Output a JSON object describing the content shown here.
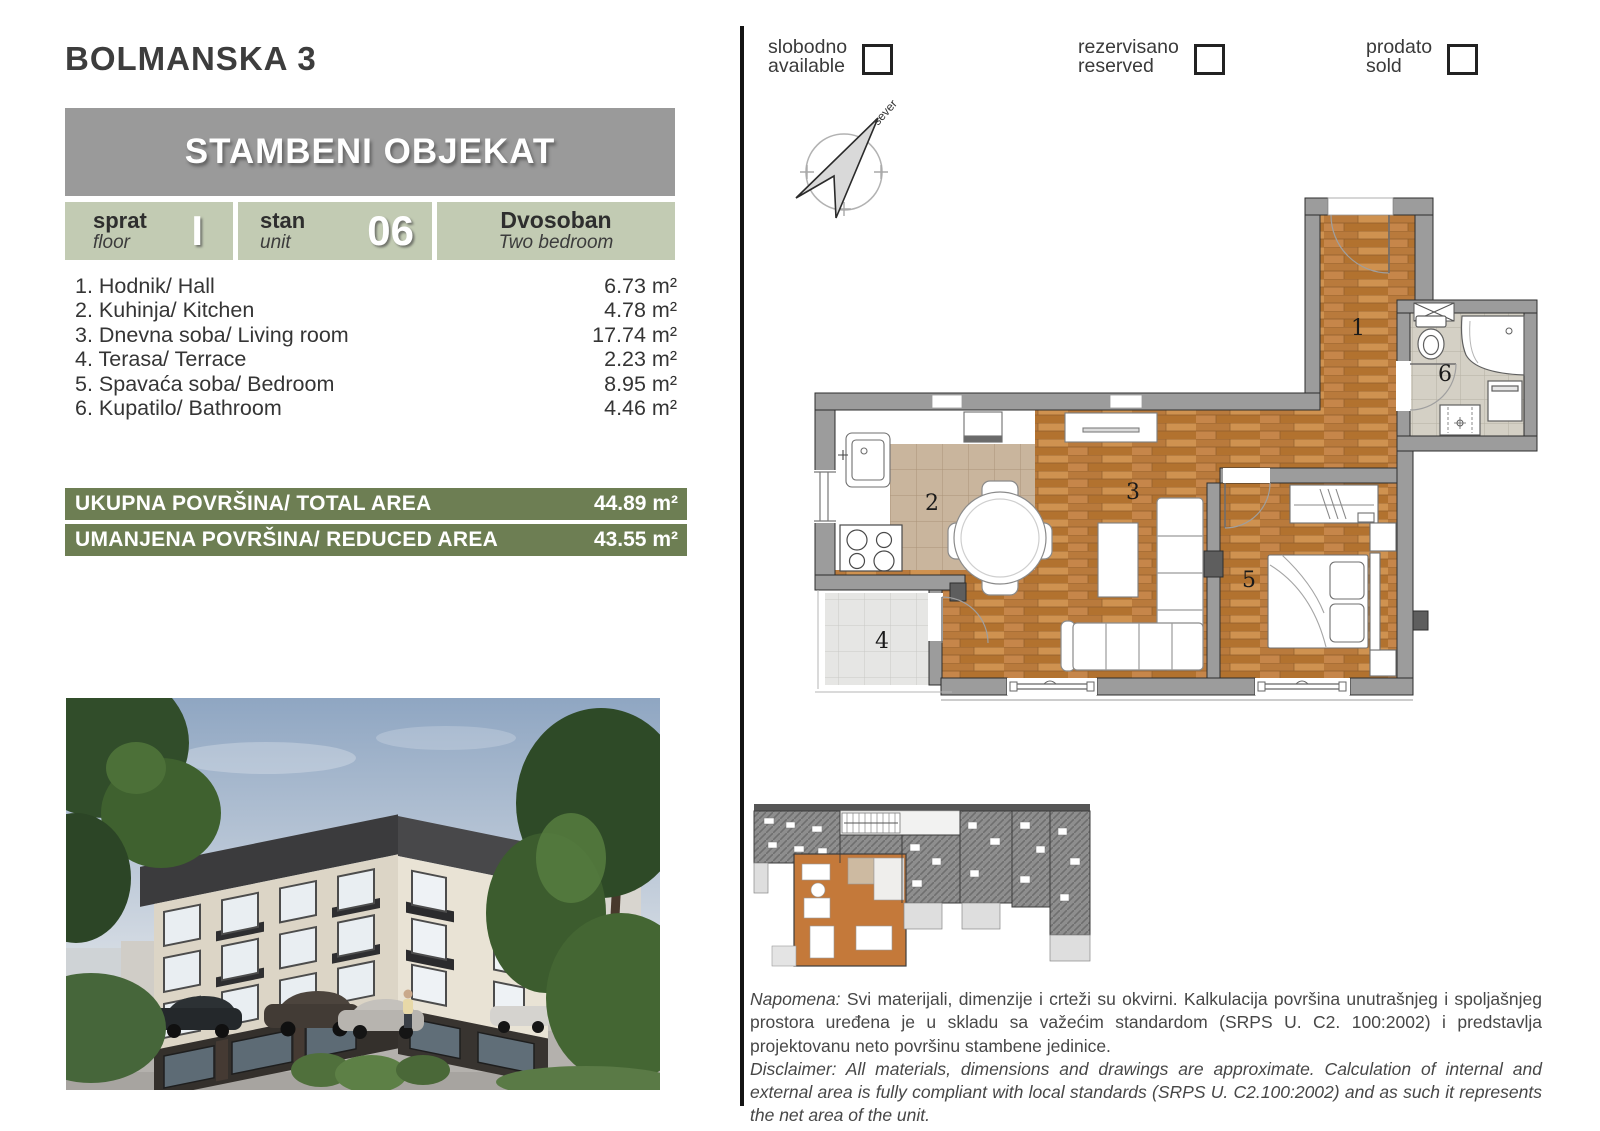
{
  "header": {
    "project_title": "BOLMANSKA 3",
    "banner_title": "STAMBENI OBJEKAT"
  },
  "info": {
    "floor": {
      "label_sr": "sprat",
      "label_en": "floor",
      "value": "I"
    },
    "unit": {
      "label_sr": "stan",
      "label_en": "unit",
      "value": "06"
    },
    "type": {
      "name_sr": "Dvosoban",
      "name_en": "Two bedroom"
    }
  },
  "rooms": [
    {
      "label": "1. Hodnik/ Hall",
      "area": "6.73 m²"
    },
    {
      "label": "2. Kuhinja/ Kitchen",
      "area": "4.78 m²"
    },
    {
      "label": "3. Dnevna soba/ Living room",
      "area": "17.74 m²"
    },
    {
      "label": "4. Terasa/ Terrace",
      "area": "2.23 m²"
    },
    {
      "label": "5. Spavaća soba/ Bedroom",
      "area": "8.95 m²"
    },
    {
      "label": "6. Kupatilo/ Bathroom",
      "area": "4.46 m²"
    }
  ],
  "totals": [
    {
      "label": "UKUPNA POVRŠINA/ TOTAL AREA",
      "value": "44.89 m²"
    },
    {
      "label": "UMANJENA POVRŠINA/ REDUCED AREA",
      "value": "43.55 m²"
    }
  ],
  "legend": {
    "items": [
      {
        "sr": "slobodno",
        "en": "available"
      },
      {
        "sr": "rezervisano",
        "en": "reserved"
      },
      {
        "sr": "prodato",
        "en": "sold"
      }
    ]
  },
  "compass": {
    "north_label": "sever"
  },
  "plan": {
    "labels": {
      "hall": "1",
      "kitchen": "2",
      "living": "3",
      "terrace": "4",
      "bedroom": "5",
      "bathroom": "6"
    }
  },
  "notes": {
    "sr_lead": "Napomena:",
    "sr_body": " Svi materijali, dimenzije i crteži su okvirni. Kalkulacija površina unutrašnjeg i spoljašnjeg prostora uređena je u skladu sa važećim standardom (SRPS U. C2. 100:2002) i predstavlja projektovanu neto površinu stambene jedinice.",
    "en_lead": "Disclaimer:",
    "en_body": " All materials, dimensions and drawings are approximate. Calculation of internal and external area is fully compliant with local standards (SRPS U. C2.100:2002) and as such it represents the net area of the unit."
  },
  "colors": {
    "accent_green": "#6d7e53",
    "sage": "#c2cbb3",
    "banner_gray": "#9a9a9a",
    "wall_gray": "#9c9c9c",
    "wood": "#c08344",
    "highlight_orange": "#c4793a"
  }
}
